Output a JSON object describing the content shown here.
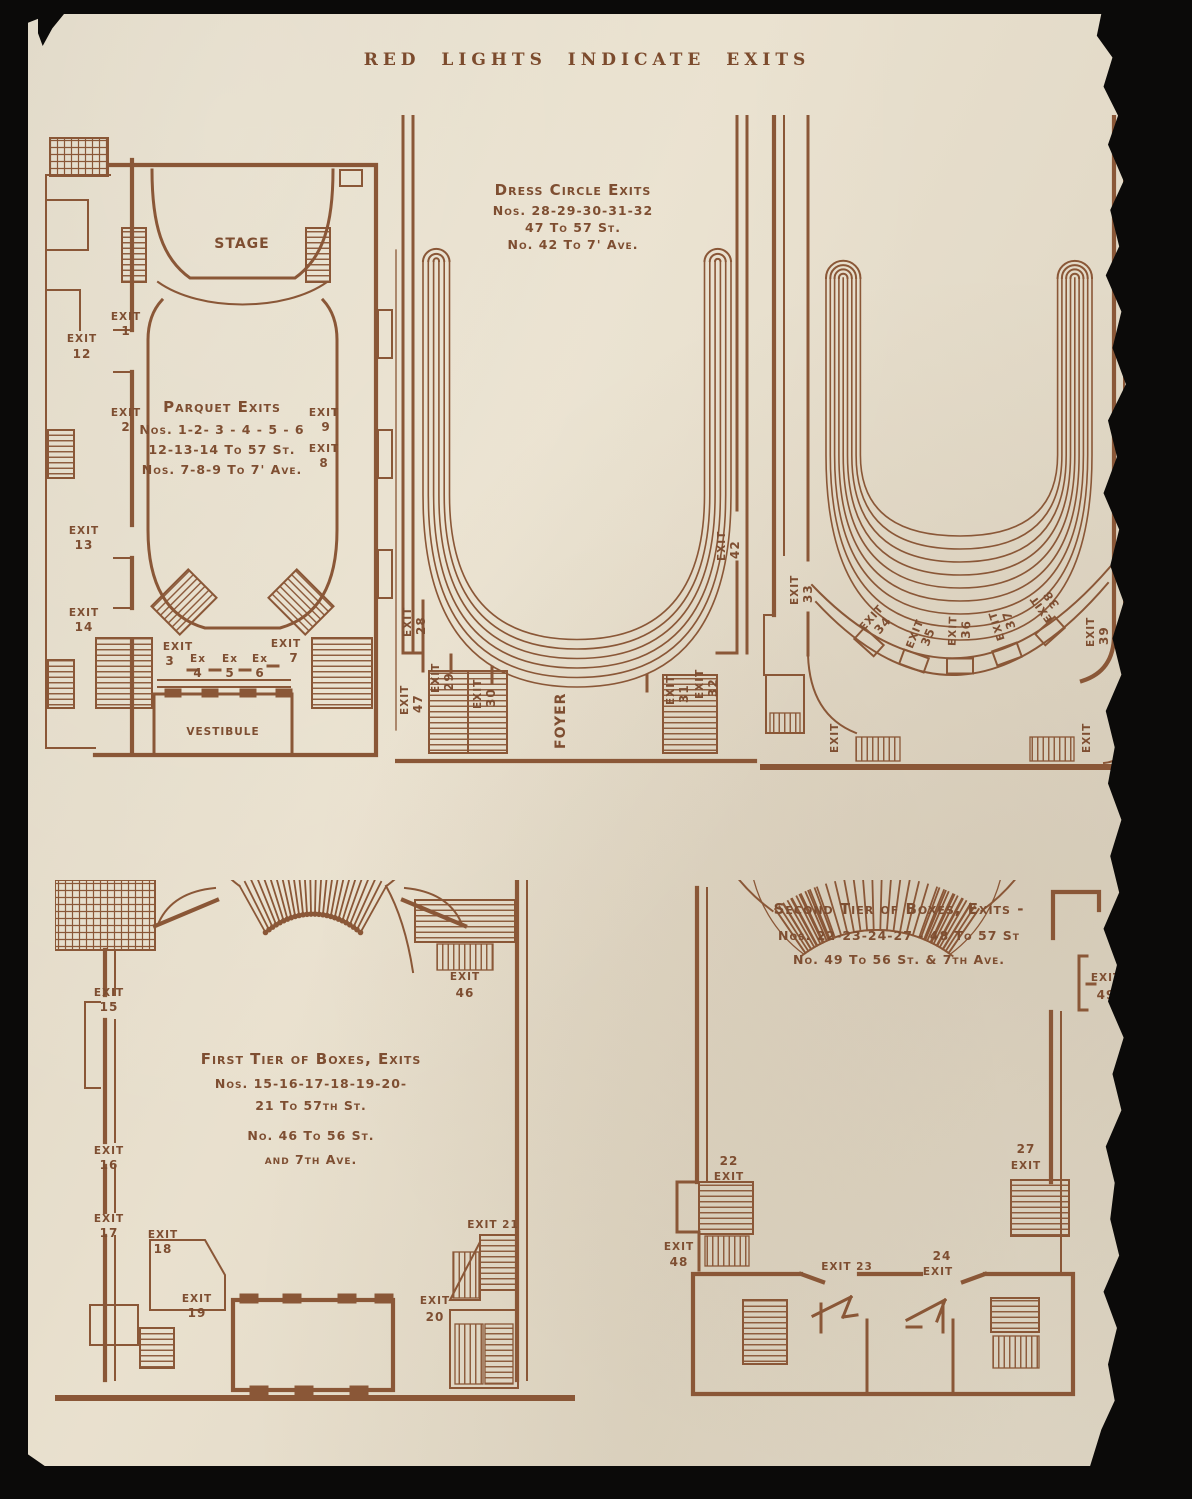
{
  "page": {
    "title": "RED LIGHTS INDICATE EXITS"
  },
  "colors": {
    "ink": "#8a5737",
    "paper": "#e8dfcc",
    "backdrop": "#0b0a09"
  },
  "plans": {
    "parquet": {
      "stage": "STAGE",
      "vestibule": "VESTIBULE",
      "heading": "Parquet Exits",
      "lines": [
        "Nos. 1-2- 3 - 4 - 5 - 6",
        "12-13-14 To 57 St.",
        "Nos. 7-8-9  To 7' Ave."
      ],
      "exits": {
        "e1": {
          "w": "EXIT",
          "n": "1"
        },
        "e2": {
          "w": "EXIT",
          "n": "2"
        },
        "e3": {
          "w": "EXIT",
          "n": "3"
        },
        "e4": {
          "w": "Ex",
          "n": "4"
        },
        "e5": {
          "w": "Ex",
          "n": "5"
        },
        "e6": {
          "w": "Ex",
          "n": "6"
        },
        "e7": {
          "w": "EXIT",
          "n": "7"
        },
        "e8": {
          "w": "EXIT",
          "n": "8"
        },
        "e9": {
          "w": "EXIT",
          "n": "9"
        },
        "e12": {
          "w": "EXIT",
          "n": "12"
        },
        "e13": {
          "w": "EXIT",
          "n": "13"
        },
        "e14": {
          "w": "EXIT",
          "n": "14"
        }
      }
    },
    "dress_circle": {
      "heading": "Dress Circle Exits",
      "lines": [
        "Nos. 28-29-30-31-32",
        "47 To 57 St.",
        "No. 42 To 7' Ave."
      ],
      "foyer": "FOYER",
      "exits": {
        "e28": {
          "w": "EXIT",
          "n": "28"
        },
        "e29": {
          "w": "EXIT",
          "n": "29"
        },
        "e30": {
          "w": "EXIT",
          "n": "30"
        },
        "e31": {
          "w": "EXIT",
          "n": "31"
        },
        "e32": {
          "w": "EXIT",
          "n": "32"
        },
        "e42": {
          "w": "EXIT",
          "n": "42"
        },
        "e47": {
          "w": "EXIT",
          "n": "47"
        }
      }
    },
    "balcony": {
      "exits": {
        "e33": {
          "w": "EXIT",
          "n": "33"
        },
        "e34": {
          "w": "EXIT",
          "n": "34"
        },
        "e35": {
          "w": "EXIT",
          "n": "35"
        },
        "e36": {
          "w": "EXIT",
          "n": "36"
        },
        "e37": {
          "w": "EXIT",
          "n": "37"
        },
        "e38": {
          "w": "EXIT",
          "n": "38"
        },
        "e39": {
          "w": "EXIT",
          "n": "39"
        },
        "corner_left": {
          "w": "EXIT"
        },
        "corner_right": {
          "w": "EXIT"
        }
      }
    },
    "first_tier": {
      "heading": "First Tier of Boxes, Exits",
      "lines": [
        "Nos. 15-16-17-18-19-20-",
        "21 To 57th St.",
        "No.  46 To 56 St.",
        "and 7th Ave."
      ],
      "exits": {
        "e15": {
          "w": "EXIT",
          "n": "15"
        },
        "e16": {
          "w": "EXIT",
          "n": "16"
        },
        "e17": {
          "w": "EXIT",
          "n": "17"
        },
        "e18": {
          "w": "EXIT",
          "n": "18"
        },
        "e19": {
          "w": "EXIT",
          "n": "19"
        },
        "e20": {
          "w": "EXIT",
          "n": "20"
        },
        "e21": {
          "label": "EXIT 21"
        },
        "e46": {
          "w": "EXIT",
          "n": "46"
        }
      }
    },
    "second_tier": {
      "heading": "Second Tier of Boxes, Exits -",
      "lines": [
        "Nos. 22-23-24-27 - 48 To 57 St",
        "No.  49 To 56 St. & 7th Ave."
      ],
      "exits": {
        "e22": {
          "n": "22",
          "w": "EXIT"
        },
        "e23": {
          "label": "EXIT 23"
        },
        "e24": {
          "n": "24",
          "w": "EXIT"
        },
        "e27": {
          "n": "27",
          "w": "EXIT"
        },
        "e48": {
          "w": "EXIT",
          "n": "48"
        },
        "e49": {
          "w": "EXIT",
          "n": "49"
        }
      }
    }
  }
}
